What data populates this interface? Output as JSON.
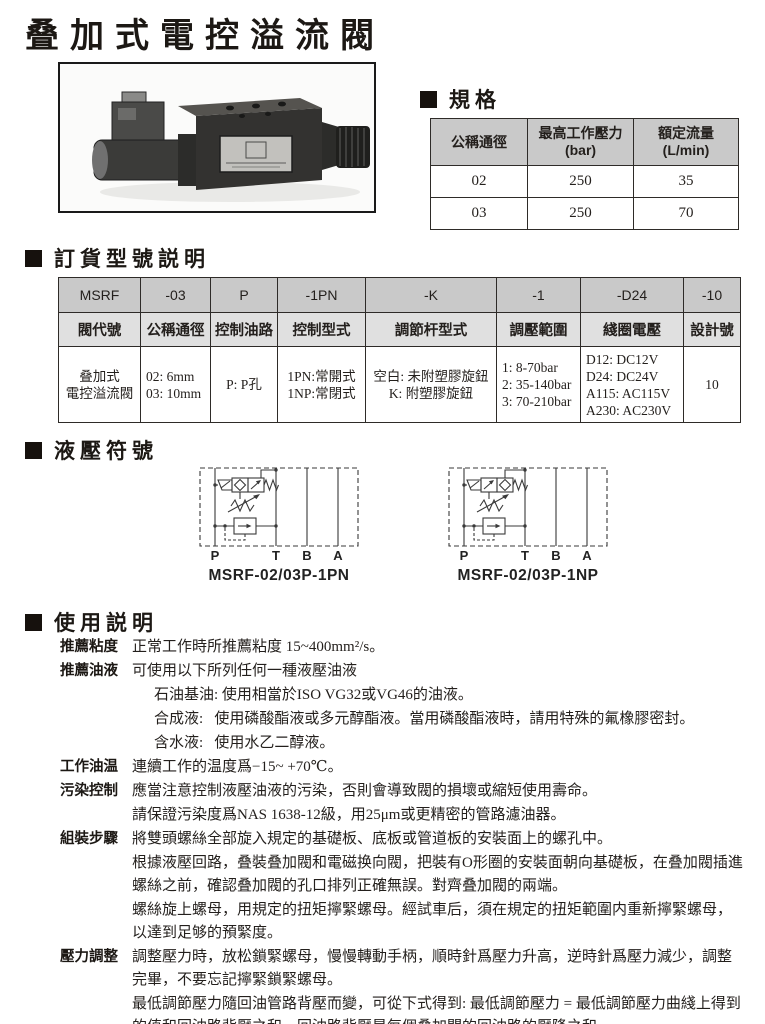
{
  "page_title": "叠加式電控溢流閥",
  "sections": {
    "specs": "規格",
    "ordering": "訂貨型號説明",
    "symbols": "液壓符號",
    "usage": "使用説明"
  },
  "specs_table": {
    "headers": [
      "公稱通徑",
      "最高工作壓力\n(bar)",
      "額定流量\n(L/min)"
    ],
    "rows": [
      [
        "02",
        "250",
        "35"
      ],
      [
        "03",
        "250",
        "70"
      ]
    ]
  },
  "ordering_table": {
    "codes": [
      "MSRF",
      "-03",
      "P",
      "-1PN",
      "-K",
      "-1",
      "-D24",
      "-10"
    ],
    "labels": [
      "閥代號",
      "公稱通徑",
      "控制油路",
      "控制型式",
      "調節杆型式",
      "調壓範圍",
      "綫圈電壓",
      "設計號"
    ],
    "values": [
      "叠加式\n電控溢流閥",
      "02: 6mm\n03: 10mm",
      "P: P孔",
      "1PN:常開式\n1NP:常閉式",
      "空白: 未附塑膠旋鈕\nK: 附塑膠旋鈕",
      "1: 8-70bar\n2: 35-140bar\n3: 70-210bar",
      "D12: DC12V\nD24: DC24V\nA115: AC115V\nA230: AC230V",
      "10"
    ]
  },
  "symbols": {
    "diagram1": {
      "caption": "MSRF-02/03P-1PN",
      "ports": [
        "P",
        "T",
        "B",
        "A"
      ]
    },
    "diagram2": {
      "caption": "MSRF-02/03P-1NP",
      "ports": [
        "P",
        "T",
        "B",
        "A"
      ]
    }
  },
  "usage_rows": [
    {
      "label": "推薦粘度",
      "text": "正常工作時所推薦粘度 15~400mm²/s。"
    },
    {
      "label": "推薦油液",
      "text": "可使用以下所列任何一種液壓油液"
    },
    {
      "label": "",
      "text": "石油基油: 使用相當於ISO VG32或VG46的油液。"
    },
    {
      "label": "",
      "text": "合成液:   使用磷酸酯液或多元醇酯液。當用磷酸酯液時，請用特殊的氟橡膠密封。"
    },
    {
      "label": "",
      "text": "含水液:   使用水乙二醇液。"
    },
    {
      "label": "工作油温",
      "text": "連續工作的温度爲−15~ +70℃。"
    },
    {
      "label": "污染控制",
      "text": "應當注意控制液壓油液的污染，否則會導致閥的損壞或縮短使用壽命。"
    },
    {
      "label": "",
      "text": "請保證污染度爲NAS 1638-12級，用25μm或更精密的管路濾油器。"
    },
    {
      "label": "組裝步驟",
      "text": "將雙頭螺絲全部旋入規定的基礎板、底板或管道板的安裝面上的螺孔中。"
    },
    {
      "label": "",
      "text": "根據液壓回路，叠裝叠加閥和電磁换向閥，把裝有O形圈的安裝面朝向基礎板，在叠加閥插進螺絲之前，確認叠加閥的孔口排列正確無誤。對齊叠加閥的兩端。"
    },
    {
      "label": "",
      "text": "螺絲旋上螺母，用規定的扭矩擰緊螺母。經試車后，須在規定的扭矩範圍内重新擰緊螺母，以達到足够的預緊度。"
    },
    {
      "label": "壓力調整",
      "text": "調整壓力時，放松鎖緊螺母，慢慢轉動手柄，順時針爲壓力升高，逆時針爲壓力減少，調整完畢，不要忘記擰緊鎖緊螺母。"
    },
    {
      "label": "",
      "text": "最低調節壓力隨回油管路背壓而變，可從下式得到: 最低調節壓力 = 最低調節壓力曲綫上得到的值和回油路背壓之和。回油路背壓是每個叠加閥的回油路的壓降之和。"
    }
  ],
  "colors": {
    "header_bg": "#c9c9c9",
    "subheader_bg": "#e0e0e0",
    "text": "#231f1c",
    "line": "#2e2b28"
  }
}
